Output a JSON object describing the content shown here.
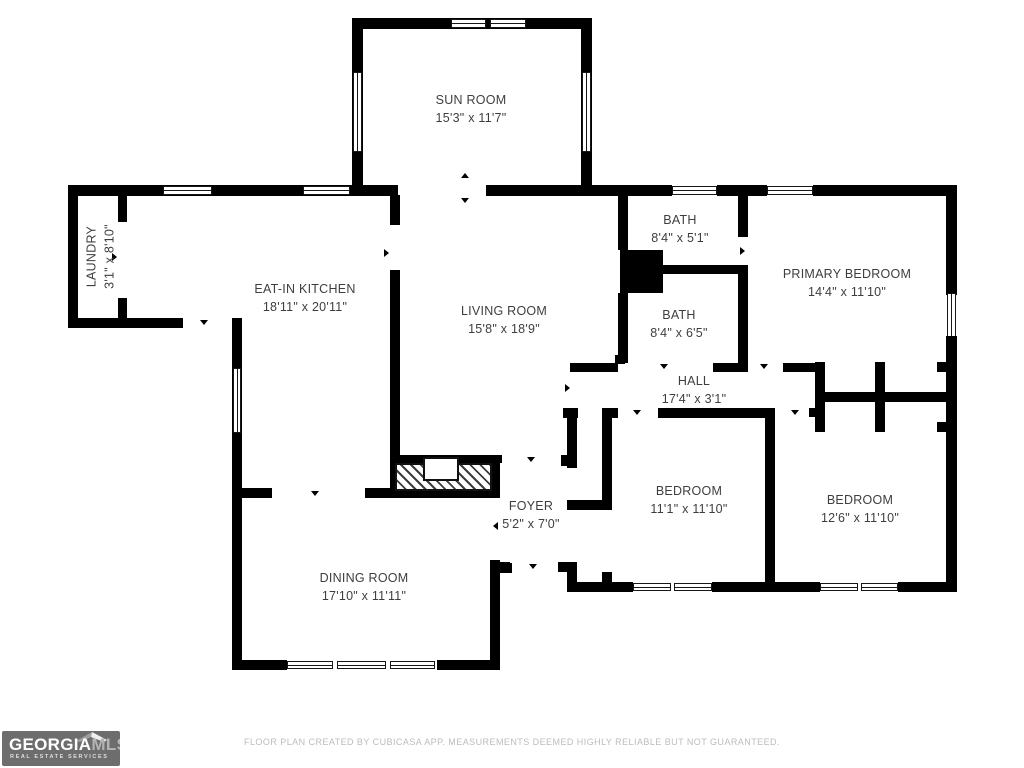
{
  "meta": {
    "footer": "FLOOR PLAN CREATED BY CUBICASA APP. MEASUREMENTS DEEMED HIGHLY RELIABLE BUT NOT GUARANTEED."
  },
  "logo": {
    "brand_primary": "GEORGIA",
    "brand_secondary": "MLS",
    "tagline": "REAL ESTATE SERVICES"
  },
  "rooms": {
    "sun_room": {
      "name": "SUN ROOM",
      "dims": "15'3\" x 11'7\""
    },
    "laundry": {
      "name": "LAUNDRY",
      "dims": "3'1\" x 8'10\""
    },
    "kitchen": {
      "name": "EAT-IN KITCHEN",
      "dims": "18'11\" x 20'11\""
    },
    "living_room": {
      "name": "LIVING ROOM",
      "dims": "15'8\" x 18'9\""
    },
    "bath_upper": {
      "name": "BATH",
      "dims": "8'4\" x 5'1\""
    },
    "bath_lower": {
      "name": "BATH",
      "dims": "8'4\" x 6'5\""
    },
    "primary_bedroom": {
      "name": "PRIMARY BEDROOM",
      "dims": "14'4\" x 11'10\""
    },
    "hall": {
      "name": "HALL",
      "dims": "17'4\" x 3'1\""
    },
    "bedroom_left": {
      "name": "BEDROOM",
      "dims": "11'1\" x 11'10\""
    },
    "bedroom_right": {
      "name": "BEDROOM",
      "dims": "12'6\" x 11'10\""
    },
    "foyer": {
      "name": "FOYER",
      "dims": "5'2\" x 7'0\""
    },
    "dining_room": {
      "name": "DINING ROOM",
      "dims": "17'10\" x 11'11\""
    }
  },
  "colors": {
    "wall": "#000000",
    "label_text": "#3e3e3e",
    "footer_text": "#bcbcbc",
    "logo_bg": "#6d6d6d",
    "logo_mls": "#b4b4b4"
  }
}
